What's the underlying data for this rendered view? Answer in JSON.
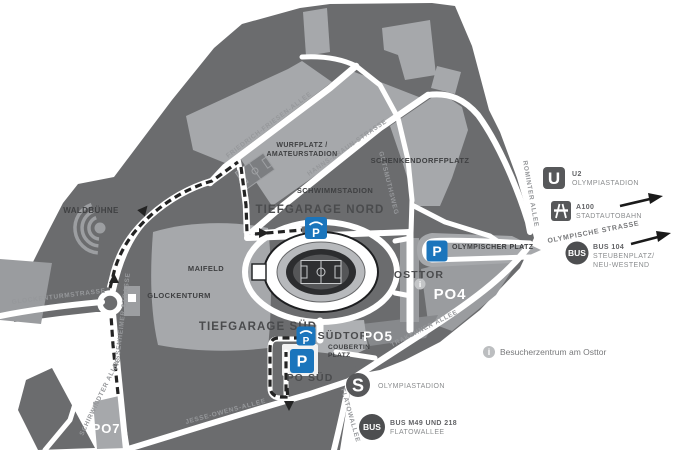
{
  "map": {
    "areas": {
      "waldbuehne": "WALDBÜHNE",
      "maifeld": "MAIFELD",
      "glockenturm": "GLOCKENTURM",
      "schwimmstadion": "SCHWIMMSTADION",
      "tiefgarage_nord": "TIEFGARAGE NORD",
      "tiefgarage_sued": "TIEFGARAGE SÜD",
      "suedtor": "SÜDTOR",
      "osttor": "OSTTOR",
      "coubertin_1": "COUBERTIN",
      "coubertin_2": "PLATZ",
      "po_sued": "PO SÜD",
      "po4": "PO4",
      "po5": "PO5",
      "po7": "PO7",
      "olympischer_platz": "OLYMPISCHER PLATZ",
      "wurfplatz_1": "WURFPLATZ /",
      "wurfplatz_2": "AMATEURSTADION",
      "schenkendorffplatz": "SCHENKENDORFFPLATZ"
    },
    "streets": {
      "friedrich_friesen": "FRIEDRICH-FRIESEN-ALLEE",
      "hanns_braun": "HANNS-BRAUN-STRASSE",
      "gutsmuthsweg": "GUTSMUTHSWEG",
      "rominter": "ROMINTER ALLEE",
      "glockenturmstrasse": "GLOCKENTURMSTRASSE",
      "passenheimer": "PASSENHEIMER STRASSE",
      "schirwindter": "SCHIRWINDTER ALLEE",
      "jesse_owens": "JESSE-OWENS-ALLEE",
      "trakehner": "TRAKEHNER ALLEE",
      "flatowallee": "FLATOWALLEE",
      "olympische": "OLYMPISCHE STRASSE"
    },
    "markers": {
      "parking": "P",
      "info": "i",
      "ubahn": "U",
      "sbahn": "S",
      "bus": "BUS"
    }
  },
  "legend": {
    "u2_line1": "U2",
    "u2_line2": "OLYMPIASTADION",
    "a100_line1": "A100",
    "a100_line2": "STADTAUTOBAHN",
    "bus104_line1": "BUS 104",
    "bus104_line2": "STEUBENPLATZ/",
    "bus104_line3": "NEU-WESTEND",
    "info_text": "Besucherzentrum am Osttor",
    "sbahn_label": "OLYMPIASTADION",
    "bus_m49_line1": "BUS M49 UND 218",
    "bus_m49_line2": "FLATOWALLEE"
  },
  "colors": {
    "map_dark": "#6b6c6e",
    "map_light": "#a6a8ab",
    "parking_blue": "#1b75bc",
    "icon_gray": "#57585a",
    "route_black": "#232323",
    "road_white": "#ffffff"
  }
}
